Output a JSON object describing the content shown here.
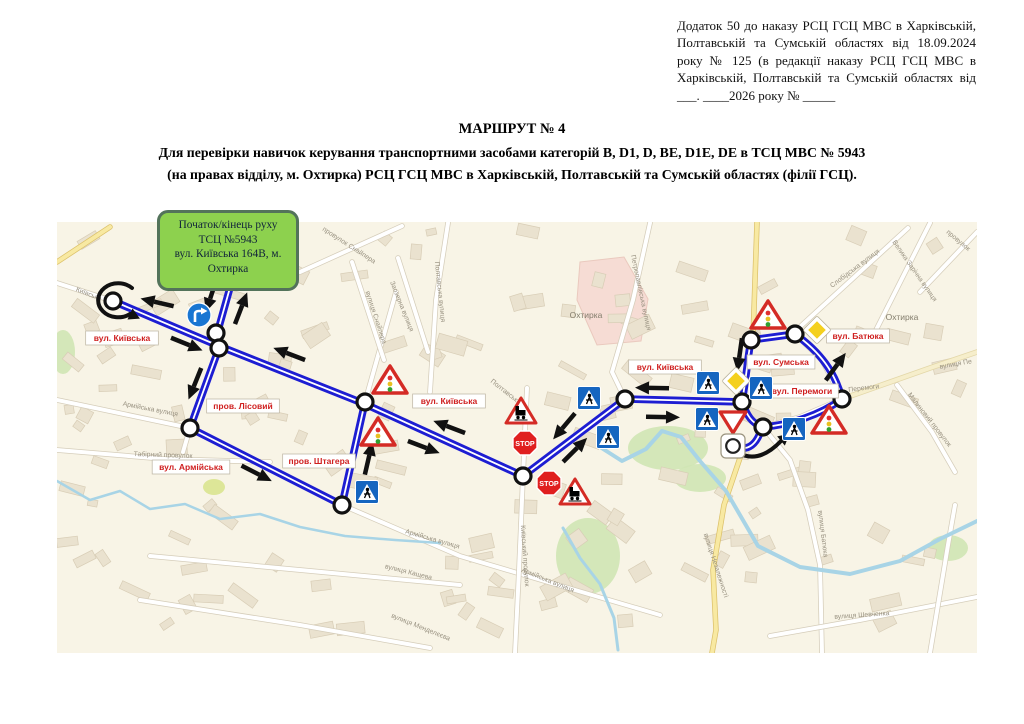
{
  "header": {
    "lines": [
      "Додаток 50 до наказу РСЦ ГСЦ МВС в Харківській,",
      "Полтавській та Сумській областях від 18.09.2024",
      "року № 125 (в редакції наказу РСЦ ГСЦ МВС в",
      "Харківській, Полтавській та Сумській областях від",
      "___. ____2026 року № _____"
    ]
  },
  "title": {
    "line1": "МАРШРУТ № 4",
    "line2": "Для перевірки навичок керування транспортними засобами категорій B, D1, D, BE, D1E, DE в ТСЦ МВС № 5943",
    "line3": "(на правах відділу, м. Охтирка) РСЦ ГСЦ МВС в Харківській, Полтавській та Сумській областях (філії ГСЦ)."
  },
  "start_box": {
    "bg": "#8dd14e",
    "border": "#53735a",
    "lines": [
      "Початок/кінець руху",
      "ТСЦ №5943",
      "вул. Київська 164В, м.",
      "Охтирка"
    ]
  },
  "map": {
    "bounds": {
      "x": 57,
      "y": 222,
      "w": 920,
      "h": 431
    },
    "bg": "#f8f4e6",
    "route_color": "#1d1dd2",
    "label_color": "#cf1f1f",
    "sign_red": "#d42b25",
    "stop_text": "STOP",
    "routes": [
      "M231,284 L217,334 L219,348",
      "M113,301 L219,346 L365,404 L523,476",
      "M219,348 L190,428",
      "M190,428 L342,505",
      "M342,505 L365,402",
      "M523,476 L625,399 L742,402",
      "M742,402 C746,380 748,355 751,340",
      "M751,340 L795,334",
      "M795,334 C820,352 835,372 842,399",
      "M842,399 C820,415 790,425 763,427",
      "M742,402 C747,416 752,423 762,427",
      "M762,427 C757,445 748,451 736,447"
    ],
    "nodes": [
      [
        113,
        301
      ],
      [
        216,
        333
      ],
      [
        219,
        348
      ],
      [
        190,
        428
      ],
      [
        342,
        505
      ],
      [
        365,
        402
      ],
      [
        523,
        476
      ],
      [
        625,
        399
      ],
      [
        742,
        402
      ],
      [
        751,
        340
      ],
      [
        795,
        334
      ],
      [
        842,
        399
      ],
      [
        763,
        427
      ]
    ],
    "arrows": [
      {
        "x": 160,
        "y": 303,
        "a": 193
      },
      {
        "x": 212,
        "y": 293,
        "a": 108
      },
      {
        "x": 240,
        "y": 311,
        "a": 291
      },
      {
        "x": 184,
        "y": 343,
        "a": 22
      },
      {
        "x": 196,
        "y": 381,
        "a": 112
      },
      {
        "x": 254,
        "y": 472,
        "a": 27
      },
      {
        "x": 368,
        "y": 461,
        "a": 283
      },
      {
        "x": 292,
        "y": 355,
        "a": 201
      },
      {
        "x": 421,
        "y": 446,
        "a": 21
      },
      {
        "x": 452,
        "y": 428,
        "a": 201
      },
      {
        "x": 566,
        "y": 424,
        "a": 130
      },
      {
        "x": 573,
        "y": 452,
        "a": 315
      },
      {
        "x": 655,
        "y": 388,
        "a": 181
      },
      {
        "x": 660,
        "y": 417,
        "a": 1
      },
      {
        "x": 740,
        "y": 352,
        "a": 98
      },
      {
        "x": 834,
        "y": 369,
        "a": 306
      }
    ],
    "curved_arrows": [
      {
        "d": "M132,288 A20,17 0 1 0 130,314",
        "hx": 130,
        "hy": 314,
        "ha": 25,
        "name": "u-turn-arrow"
      },
      {
        "d": "M737,452 Q758,465 781,441",
        "hx": 781,
        "hy": 441,
        "ha": -40,
        "name": "roundabout-arrow"
      }
    ],
    "street_labels": [
      {
        "t": "вул. Київська",
        "x": 122,
        "y": 338
      },
      {
        "t": "пров. Лісовий",
        "x": 243,
        "y": 406
      },
      {
        "t": "вул. Армійська",
        "x": 191,
        "y": 467
      },
      {
        "t": "пров. Штагера",
        "x": 319,
        "y": 461
      },
      {
        "t": "вул. Київська",
        "x": 449,
        "y": 401
      },
      {
        "t": "вул. Київська",
        "x": 665,
        "y": 367
      },
      {
        "t": "вул. Сумська",
        "x": 781,
        "y": 362
      },
      {
        "t": "вул. Батюка",
        "x": 858,
        "y": 336
      },
      {
        "t": "вул. Перемоги",
        "x": 802,
        "y": 391
      }
    ],
    "signs": [
      {
        "k": "turn-right",
        "x": 199,
        "y": 315
      },
      {
        "k": "traffic-light",
        "x": 390,
        "y": 381
      },
      {
        "k": "traffic-light",
        "x": 378,
        "y": 433
      },
      {
        "k": "traffic-light",
        "x": 768,
        "y": 316
      },
      {
        "k": "traffic-light",
        "x": 829,
        "y": 421
      },
      {
        "k": "pedestrian",
        "x": 367,
        "y": 492
      },
      {
        "k": "pedestrian",
        "x": 589,
        "y": 398
      },
      {
        "k": "pedestrian",
        "x": 608,
        "y": 437
      },
      {
        "k": "pedestrian",
        "x": 708,
        "y": 383
      },
      {
        "k": "pedestrian",
        "x": 707,
        "y": 419
      },
      {
        "k": "pedestrian",
        "x": 761,
        "y": 388
      },
      {
        "k": "pedestrian",
        "x": 794,
        "y": 429
      },
      {
        "k": "railway",
        "x": 521,
        "y": 412
      },
      {
        "k": "railway",
        "x": 575,
        "y": 493
      },
      {
        "k": "stop",
        "x": 525,
        "y": 443
      },
      {
        "k": "stop",
        "x": 549,
        "y": 483
      },
      {
        "k": "priority",
        "x": 736,
        "y": 381
      },
      {
        "k": "priority",
        "x": 817,
        "y": 330
      },
      {
        "k": "give-way",
        "x": 733,
        "y": 421
      },
      {
        "k": "roundabout",
        "x": 733,
        "y": 446
      }
    ],
    "map_names": [
      {
        "t": "Київська",
        "x": 88,
        "y": 296,
        "r": 22
      },
      {
        "t": "провулок Снайпера",
        "x": 348,
        "y": 247,
        "r": 33
      },
      {
        "t": "вулиця Снайпера",
        "x": 374,
        "y": 318,
        "r": 72
      },
      {
        "t": "Заозерна вулиця",
        "x": 400,
        "y": 307,
        "r": 68
      },
      {
        "t": "Полтавська вулиця",
        "x": 438,
        "y": 292,
        "r": 84
      },
      {
        "t": "Полтавська ву",
        "x": 508,
        "y": 396,
        "r": 38
      },
      {
        "t": "Армійська вулиця",
        "x": 150,
        "y": 411,
        "r": 11
      },
      {
        "t": "Табірний провулок",
        "x": 163,
        "y": 457,
        "r": 2
      },
      {
        "t": "Армійська вулиця",
        "x": 432,
        "y": 541,
        "r": 16
      },
      {
        "t": "Армійська вулиця",
        "x": 547,
        "y": 582,
        "r": 22
      },
      {
        "t": "вулиця Кащева",
        "x": 408,
        "y": 574,
        "r": 14
      },
      {
        "t": "вулиця Менделєєва",
        "x": 420,
        "y": 629,
        "r": 22
      },
      {
        "t": "Київський провулок",
        "x": 523,
        "y": 556,
        "r": 86
      },
      {
        "t": "Охтирка",
        "x": 586,
        "y": 318,
        "r": 0,
        "town": 1
      },
      {
        "t": "Петропавлівська вулиця",
        "x": 639,
        "y": 293,
        "r": 78
      },
      {
        "t": "вулиця Незалежності",
        "x": 714,
        "y": 566,
        "r": 72
      },
      {
        "t": "вулиця Батюка",
        "x": 821,
        "y": 534,
        "r": 83
      },
      {
        "t": "вулиця Шевченка",
        "x": 862,
        "y": 617,
        "r": -4
      },
      {
        "t": "Перемоги",
        "x": 864,
        "y": 390,
        "r": -7
      },
      {
        "t": "Малиновий провулок",
        "x": 928,
        "y": 421,
        "r": 52
      },
      {
        "t": "Слобідська вулиця",
        "x": 856,
        "y": 270,
        "r": -37
      },
      {
        "t": "Велика Зарічна вулиця",
        "x": 913,
        "y": 272,
        "r": 55
      },
      {
        "t": "Охтирка",
        "x": 902,
        "y": 320,
        "r": 0,
        "town": 1
      },
      {
        "t": "провулок",
        "x": 957,
        "y": 242,
        "r": 40
      },
      {
        "t": "вулиця Пе",
        "x": 956,
        "y": 366,
        "r": -10
      }
    ],
    "roads": [
      {
        "p": [
          [
            57,
            283
          ],
          [
            113,
            301
          ],
          [
            219,
            346
          ],
          [
            365,
            404
          ],
          [
            523,
            476
          ]
        ]
      },
      {
        "p": [
          [
            523,
            476
          ],
          [
            625,
            399
          ],
          [
            742,
            402
          ]
        ]
      },
      {
        "p": [
          [
            742,
            402
          ],
          [
            748,
            368
          ],
          [
            751,
            340
          ],
          [
            795,
            334
          ],
          [
            822,
            360
          ],
          [
            842,
            399
          ],
          [
            800,
            417
          ],
          [
            763,
            427
          ]
        ]
      },
      {
        "p": [
          [
            233,
            240
          ],
          [
            231,
            285
          ],
          [
            217,
            334
          ],
          [
            219,
            348
          ],
          [
            190,
            428
          ],
          [
            183,
            452
          ]
        ]
      },
      {
        "p": [
          [
            57,
            400
          ],
          [
            190,
            428
          ],
          [
            342,
            505
          ],
          [
            460,
            556
          ],
          [
            575,
            590
          ],
          [
            660,
            615
          ]
        ]
      },
      {
        "p": [
          [
            342,
            505
          ],
          [
            365,
            402
          ],
          [
            396,
            292
          ]
        ]
      },
      {
        "p": [
          [
            448,
            223
          ],
          [
            436,
            300
          ],
          [
            430,
            392
          ]
        ]
      },
      {
        "p": [
          [
            300,
            272
          ],
          [
            402,
            226
          ]
        ]
      },
      {
        "p": [
          [
            352,
            262
          ],
          [
            384,
            360
          ]
        ]
      },
      {
        "p": [
          [
            398,
            258
          ],
          [
            428,
            352
          ]
        ]
      },
      {
        "p": [
          [
            650,
            223
          ],
          [
            633,
            300
          ],
          [
            612,
            372
          ],
          [
            625,
            399
          ]
        ]
      },
      {
        "p": [
          [
            790,
            336
          ],
          [
            908,
            228
          ]
        ]
      },
      {
        "p": [
          [
            872,
            338
          ],
          [
            930,
            223
          ]
        ]
      },
      {
        "p": [
          [
            920,
            292
          ],
          [
            977,
            232
          ]
        ]
      },
      {
        "p": [
          [
            527,
            388
          ],
          [
            523,
            476
          ],
          [
            519,
            570
          ],
          [
            515,
            653
          ]
        ]
      },
      {
        "p": [
          [
            763,
            427
          ],
          [
            790,
            460
          ],
          [
            808,
            510
          ],
          [
            820,
            565
          ],
          [
            822,
            653
          ]
        ]
      },
      {
        "p": [
          [
            770,
            636
          ],
          [
            860,
            620
          ],
          [
            977,
            597
          ]
        ]
      },
      {
        "p": [
          [
            897,
            385
          ],
          [
            932,
            432
          ],
          [
            955,
            472
          ]
        ]
      },
      {
        "p": [
          [
            930,
            653
          ],
          [
            948,
            545
          ],
          [
            955,
            505
          ]
        ]
      },
      {
        "p": [
          [
            150,
            556
          ],
          [
            300,
            570
          ],
          [
            460,
            585
          ]
        ]
      },
      {
        "p": [
          [
            140,
            600
          ],
          [
            300,
            625
          ],
          [
            430,
            648
          ]
        ]
      },
      {
        "p": [
          [
            57,
            450
          ],
          [
            165,
            459
          ],
          [
            270,
            462
          ]
        ]
      },
      {
        "p": [
          [
            57,
            262
          ],
          [
            110,
            227
          ]
        ],
        "y": 1
      },
      {
        "p": [
          [
            757,
            223
          ],
          [
            753,
            338
          ]
        ],
        "y": 1
      },
      {
        "p": [
          [
            742,
            452
          ],
          [
            724,
            505
          ],
          [
            713,
            570
          ],
          [
            716,
            630
          ],
          [
            712,
            653
          ]
        ],
        "y": 1
      },
      {
        "p": [
          [
            842,
            399
          ],
          [
            930,
            368
          ],
          [
            977,
            352
          ]
        ],
        "y": 2
      }
    ],
    "rivers": [
      {
        "p": [
          [
            600,
            447
          ],
          [
            622,
            461
          ],
          [
            646,
            449
          ],
          [
            662,
            431
          ],
          [
            681,
            437
          ],
          [
            700,
            461
          ],
          [
            726,
            491
          ],
          [
            758,
            546
          ],
          [
            800,
            567
          ],
          [
            850,
            574
          ],
          [
            900,
            561
          ],
          [
            940,
            539
          ],
          [
            977,
            521
          ]
        ],
        "w": 4
      },
      {
        "p": [
          [
            563,
            528
          ],
          [
            580,
            558
          ],
          [
            600,
            584
          ],
          [
            614,
            618
          ],
          [
            618,
            650
          ]
        ],
        "w": 3
      },
      {
        "p": [
          [
            57,
            481
          ],
          [
            90,
            500
          ],
          [
            120,
            491
          ],
          [
            150,
            509
          ],
          [
            185,
            504
          ],
          [
            220,
            519
          ],
          [
            260,
            514
          ],
          [
            300,
            527
          ],
          [
            345,
            536
          ],
          [
            395,
            540
          ],
          [
            440,
            543
          ]
        ],
        "w": 2.5
      }
    ],
    "greens": [
      {
        "x": 668,
        "y": 448,
        "rx": 40,
        "ry": 22
      },
      {
        "x": 588,
        "y": 556,
        "rx": 32,
        "ry": 38
      },
      {
        "x": 700,
        "y": 478,
        "rx": 26,
        "ry": 14
      },
      {
        "x": 63,
        "y": 352,
        "rx": 12,
        "ry": 22
      },
      {
        "x": 948,
        "y": 548,
        "rx": 20,
        "ry": 13
      },
      {
        "x": 214,
        "y": 487,
        "rx": 11,
        "ry": 8,
        "c": "#d9e48f"
      }
    ],
    "pink_zone": [
      [
        580,
        262
      ],
      [
        624,
        257
      ],
      [
        648,
        299
      ],
      [
        641,
        341
      ],
      [
        597,
        345
      ],
      [
        577,
        300
      ]
    ]
  }
}
